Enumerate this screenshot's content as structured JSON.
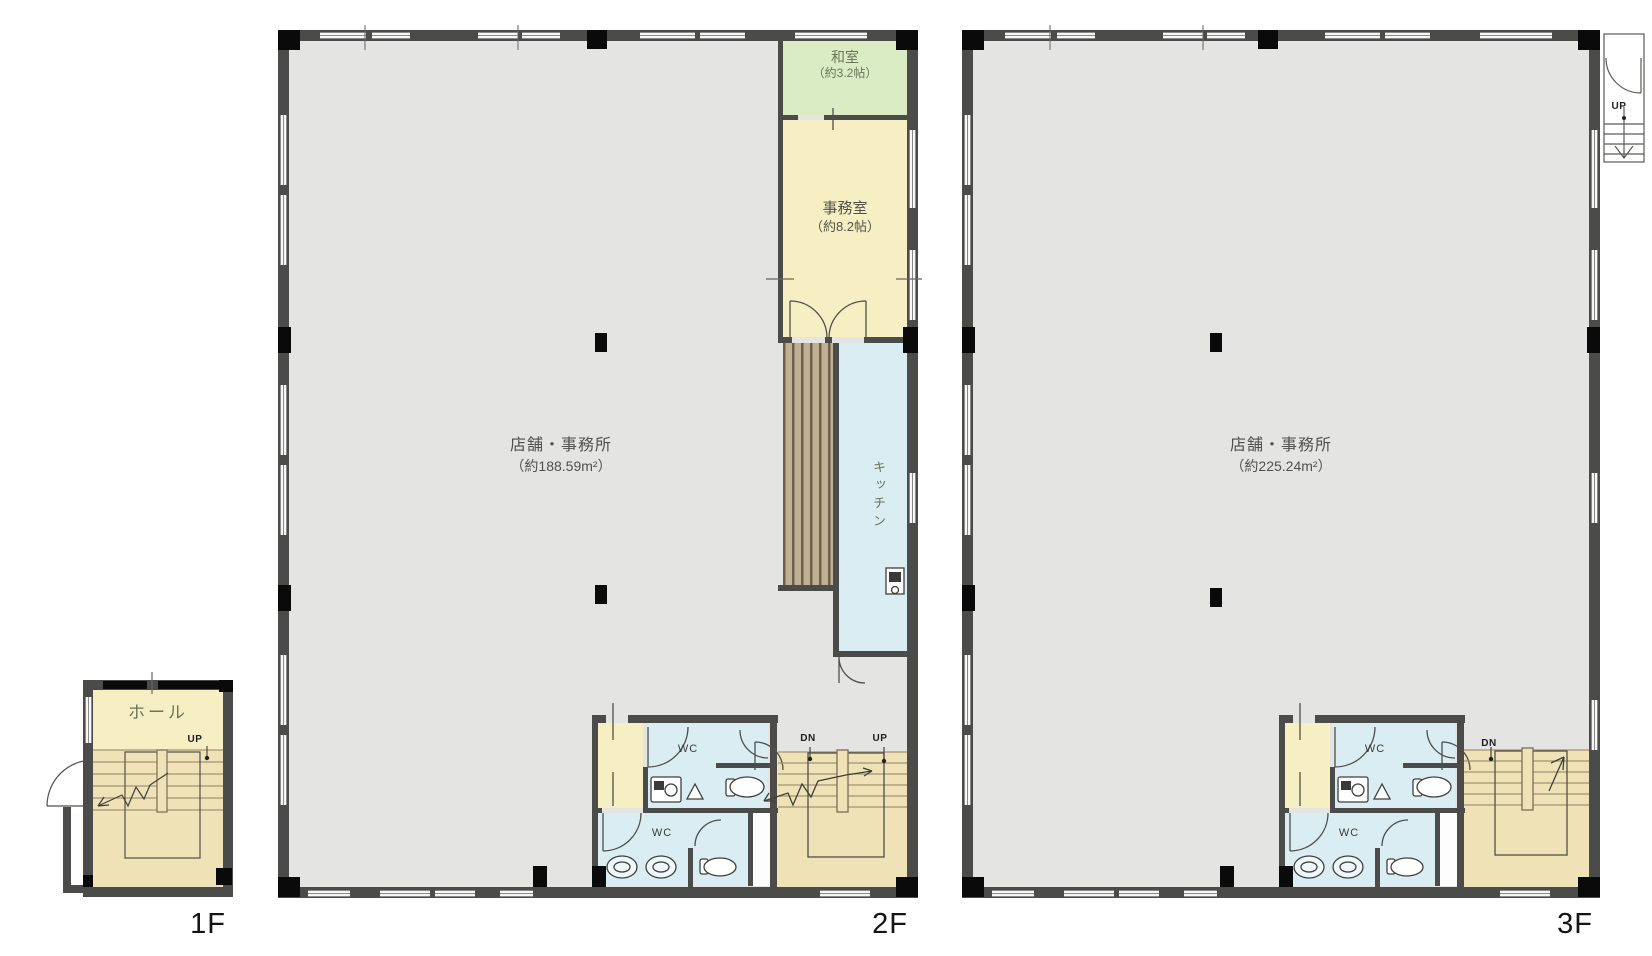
{
  "palette": {
    "wall": "#4b4b49",
    "pillar": "#0a0a0a",
    "floor-gray": "#e4e4e3",
    "cream": "#f6efc4",
    "tan": "#efe2b7",
    "green": "#d9ecc4",
    "blue": "#d9edf2",
    "hatch-light": "#c0b195",
    "hatch-dark": "#6f6049",
    "room-text": "#6a7558",
    "dim-text": "#51514b"
  },
  "floor1": {
    "name_label": "1F",
    "hall": "ホール",
    "up": "UP"
  },
  "floor2": {
    "name_label": "2F",
    "shop": {
      "name": "店舗・事務所",
      "area": "（約188.59m²）"
    },
    "washitsu": {
      "name": "和室",
      "size": "（約3.2帖）"
    },
    "office": {
      "name": "事務室",
      "size": "（約8.2帖）"
    },
    "kitchen": "キッチン",
    "wc_upper": "WC",
    "wc_lower": "WC",
    "dn": "DN",
    "up": "UP"
  },
  "floor3": {
    "name_label": "3F",
    "shop": {
      "name": "店舗・事務所",
      "area": "（約225.24m²）"
    },
    "wc_upper": "WC",
    "wc_lower": "WC",
    "dn": "DN",
    "up": "UP"
  }
}
